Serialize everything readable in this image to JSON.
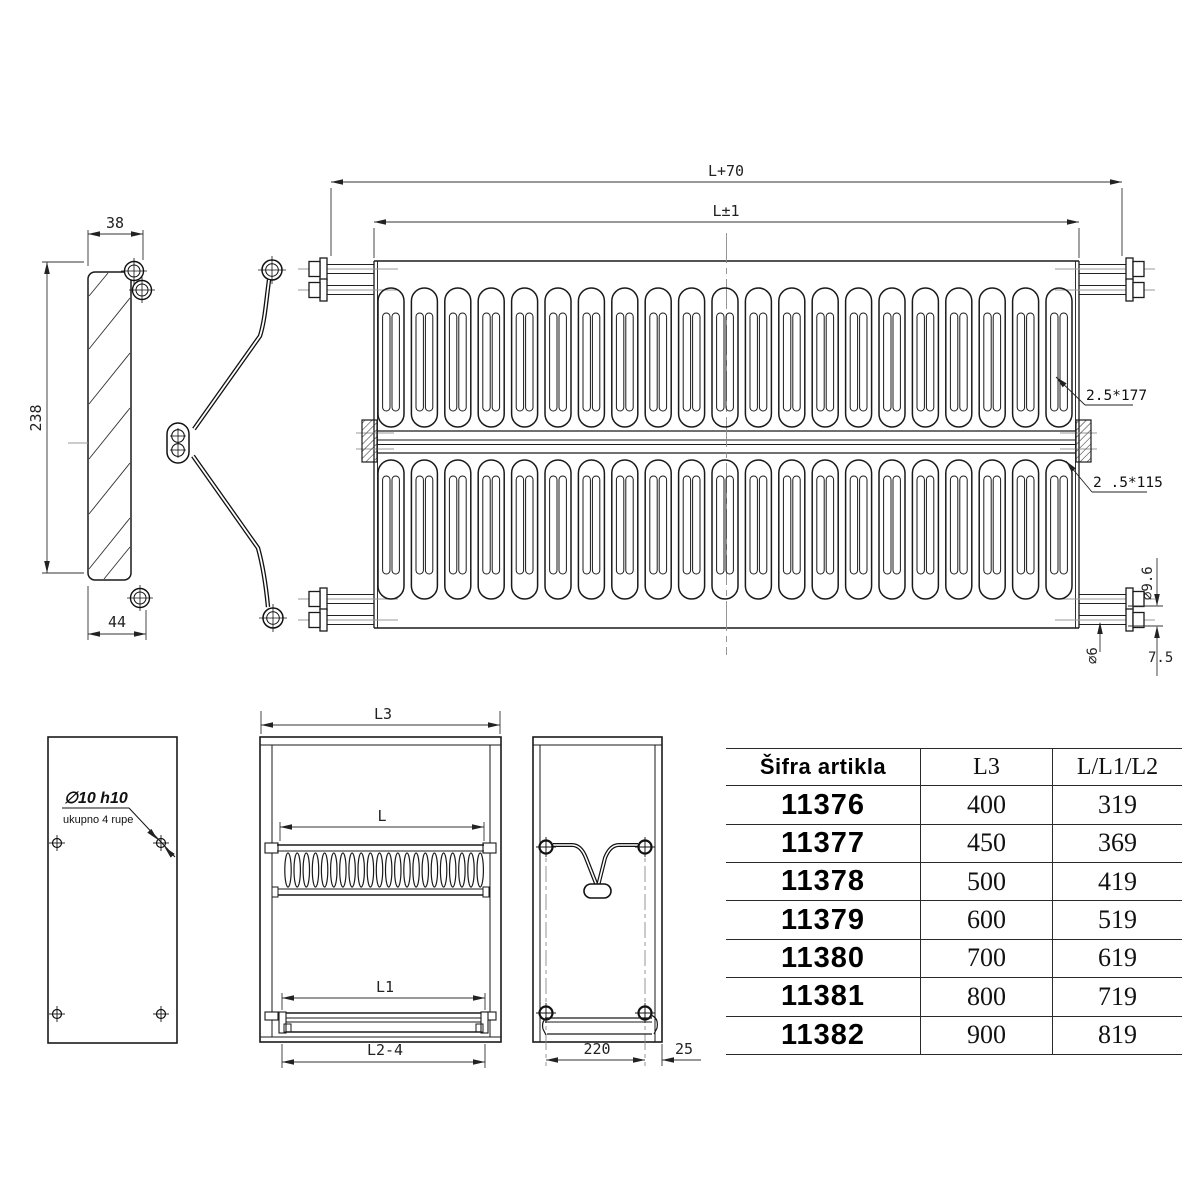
{
  "main_view": {
    "dim_overall": "L+70",
    "dim_length": "L±1",
    "note_wire_top": "2.5*177",
    "note_wire_bottom": "2 .5*115",
    "dia_outer": "∅9.6",
    "dia_inner": "∅6",
    "dim_offset": "7.5"
  },
  "bracket_view": {
    "dim_top": "38",
    "dim_height": "238",
    "dim_bottom": "44"
  },
  "back_panel": {
    "hole_spec": "∅10 h10",
    "hole_note": "ukupno 4 rupe"
  },
  "front_view": {
    "dim_l3": "L3",
    "dim_l": "L",
    "dim_l1": "L1",
    "dim_l2": "L2-4"
  },
  "side_view": {
    "dim_spacing": "220",
    "dim_edge": "25"
  },
  "table": {
    "headers": [
      "Šifra artikla",
      "L3",
      "L/L1/L2"
    ],
    "rows": [
      {
        "code": "11376",
        "l3": "400",
        "l": "319"
      },
      {
        "code": "11377",
        "l3": "450",
        "l": "369"
      },
      {
        "code": "11378",
        "l3": "500",
        "l": "419"
      },
      {
        "code": "11379",
        "l3": "600",
        "l": "519"
      },
      {
        "code": "11380",
        "l3": "700",
        "l": "619"
      },
      {
        "code": "11381",
        "l3": "800",
        "l": "719"
      },
      {
        "code": "11382",
        "l3": "900",
        "l": "819"
      }
    ]
  },
  "colors": {
    "line": "#1a1a1a",
    "dim": "#333333",
    "centerline": "#999999"
  }
}
